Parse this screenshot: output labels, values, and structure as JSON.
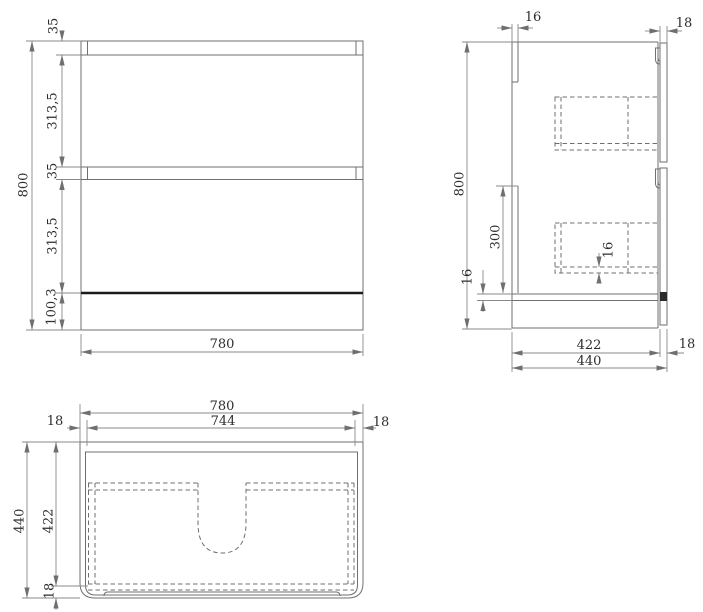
{
  "drawing_type": "vanity-cabinet-three-view-technical-drawing",
  "colors": {
    "background": "#ffffff",
    "line": "#6f6f6f",
    "thick_line": "#1b1b1b",
    "dim_line": "#8a8a8a",
    "text": "#2d2d2d"
  },
  "front_view": {
    "dim_total_height": "800",
    "dim_top_gap": "35",
    "dim_drawer_top": "313,5",
    "dim_mid_gap": "35",
    "dim_drawer_bottom": "313,5",
    "dim_base": "100,3",
    "dim_total_width": "780"
  },
  "side_view": {
    "dim_back_panel": "16",
    "dim_front_panel": "18",
    "dim_total_height": "800",
    "dim_back_rail": "300",
    "dim_bottom_panel": "16",
    "dim_drawer_bottom_panel": "16",
    "dim_inner_depth": "422",
    "dim_front_thickness": "18",
    "dim_total_depth": "440"
  },
  "plan_view": {
    "dim_total_width": "780",
    "dim_inner_width": "744",
    "dim_wall_left": "18",
    "dim_wall_right": "18",
    "dim_total_depth": "440",
    "dim_inner_depth": "422",
    "dim_front_thickness": "18"
  }
}
